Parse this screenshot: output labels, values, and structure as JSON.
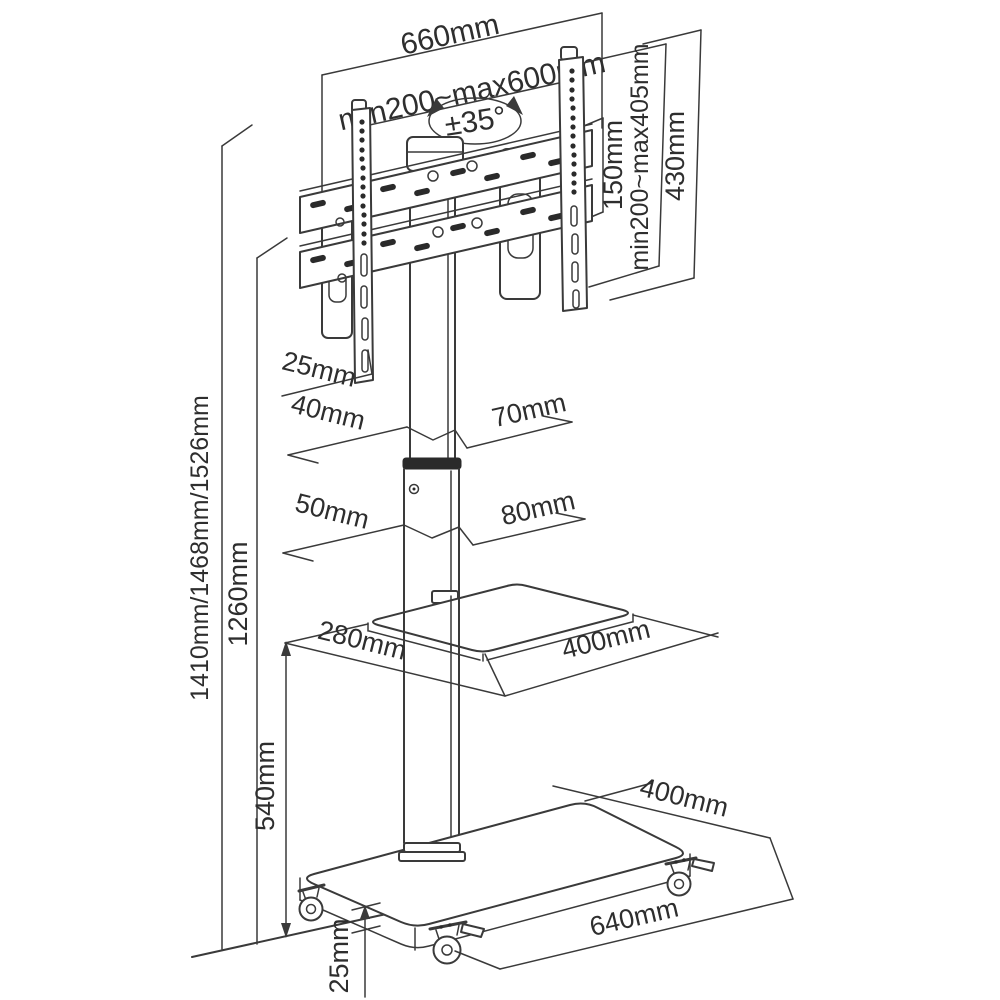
{
  "labels": {
    "bracket_width": "660mm",
    "vesa_horizontal_range": "min200~max600mm",
    "swivel_angle": "±35°",
    "vesa_hole_spacing": "150mm",
    "vesa_vertical_range": "min200~max405mm",
    "bracket_height": "430mm",
    "bracket_hook_depth": "25mm",
    "upper_column_depth": "40mm",
    "upper_column_width": "70mm",
    "lower_column_depth": "50mm",
    "lower_column_width": "80mm",
    "shelf_depth": "280mm",
    "shelf_width": "400mm",
    "total_heights": "1410mm/1468mm/1526mm",
    "column_height": "1260mm",
    "shelf_height": "540mm",
    "base_depth": "400mm",
    "base_width": "640mm",
    "base_thickness": "25mm"
  },
  "colors": {
    "line": "#3a3a3a",
    "background": "#ffffff"
  }
}
